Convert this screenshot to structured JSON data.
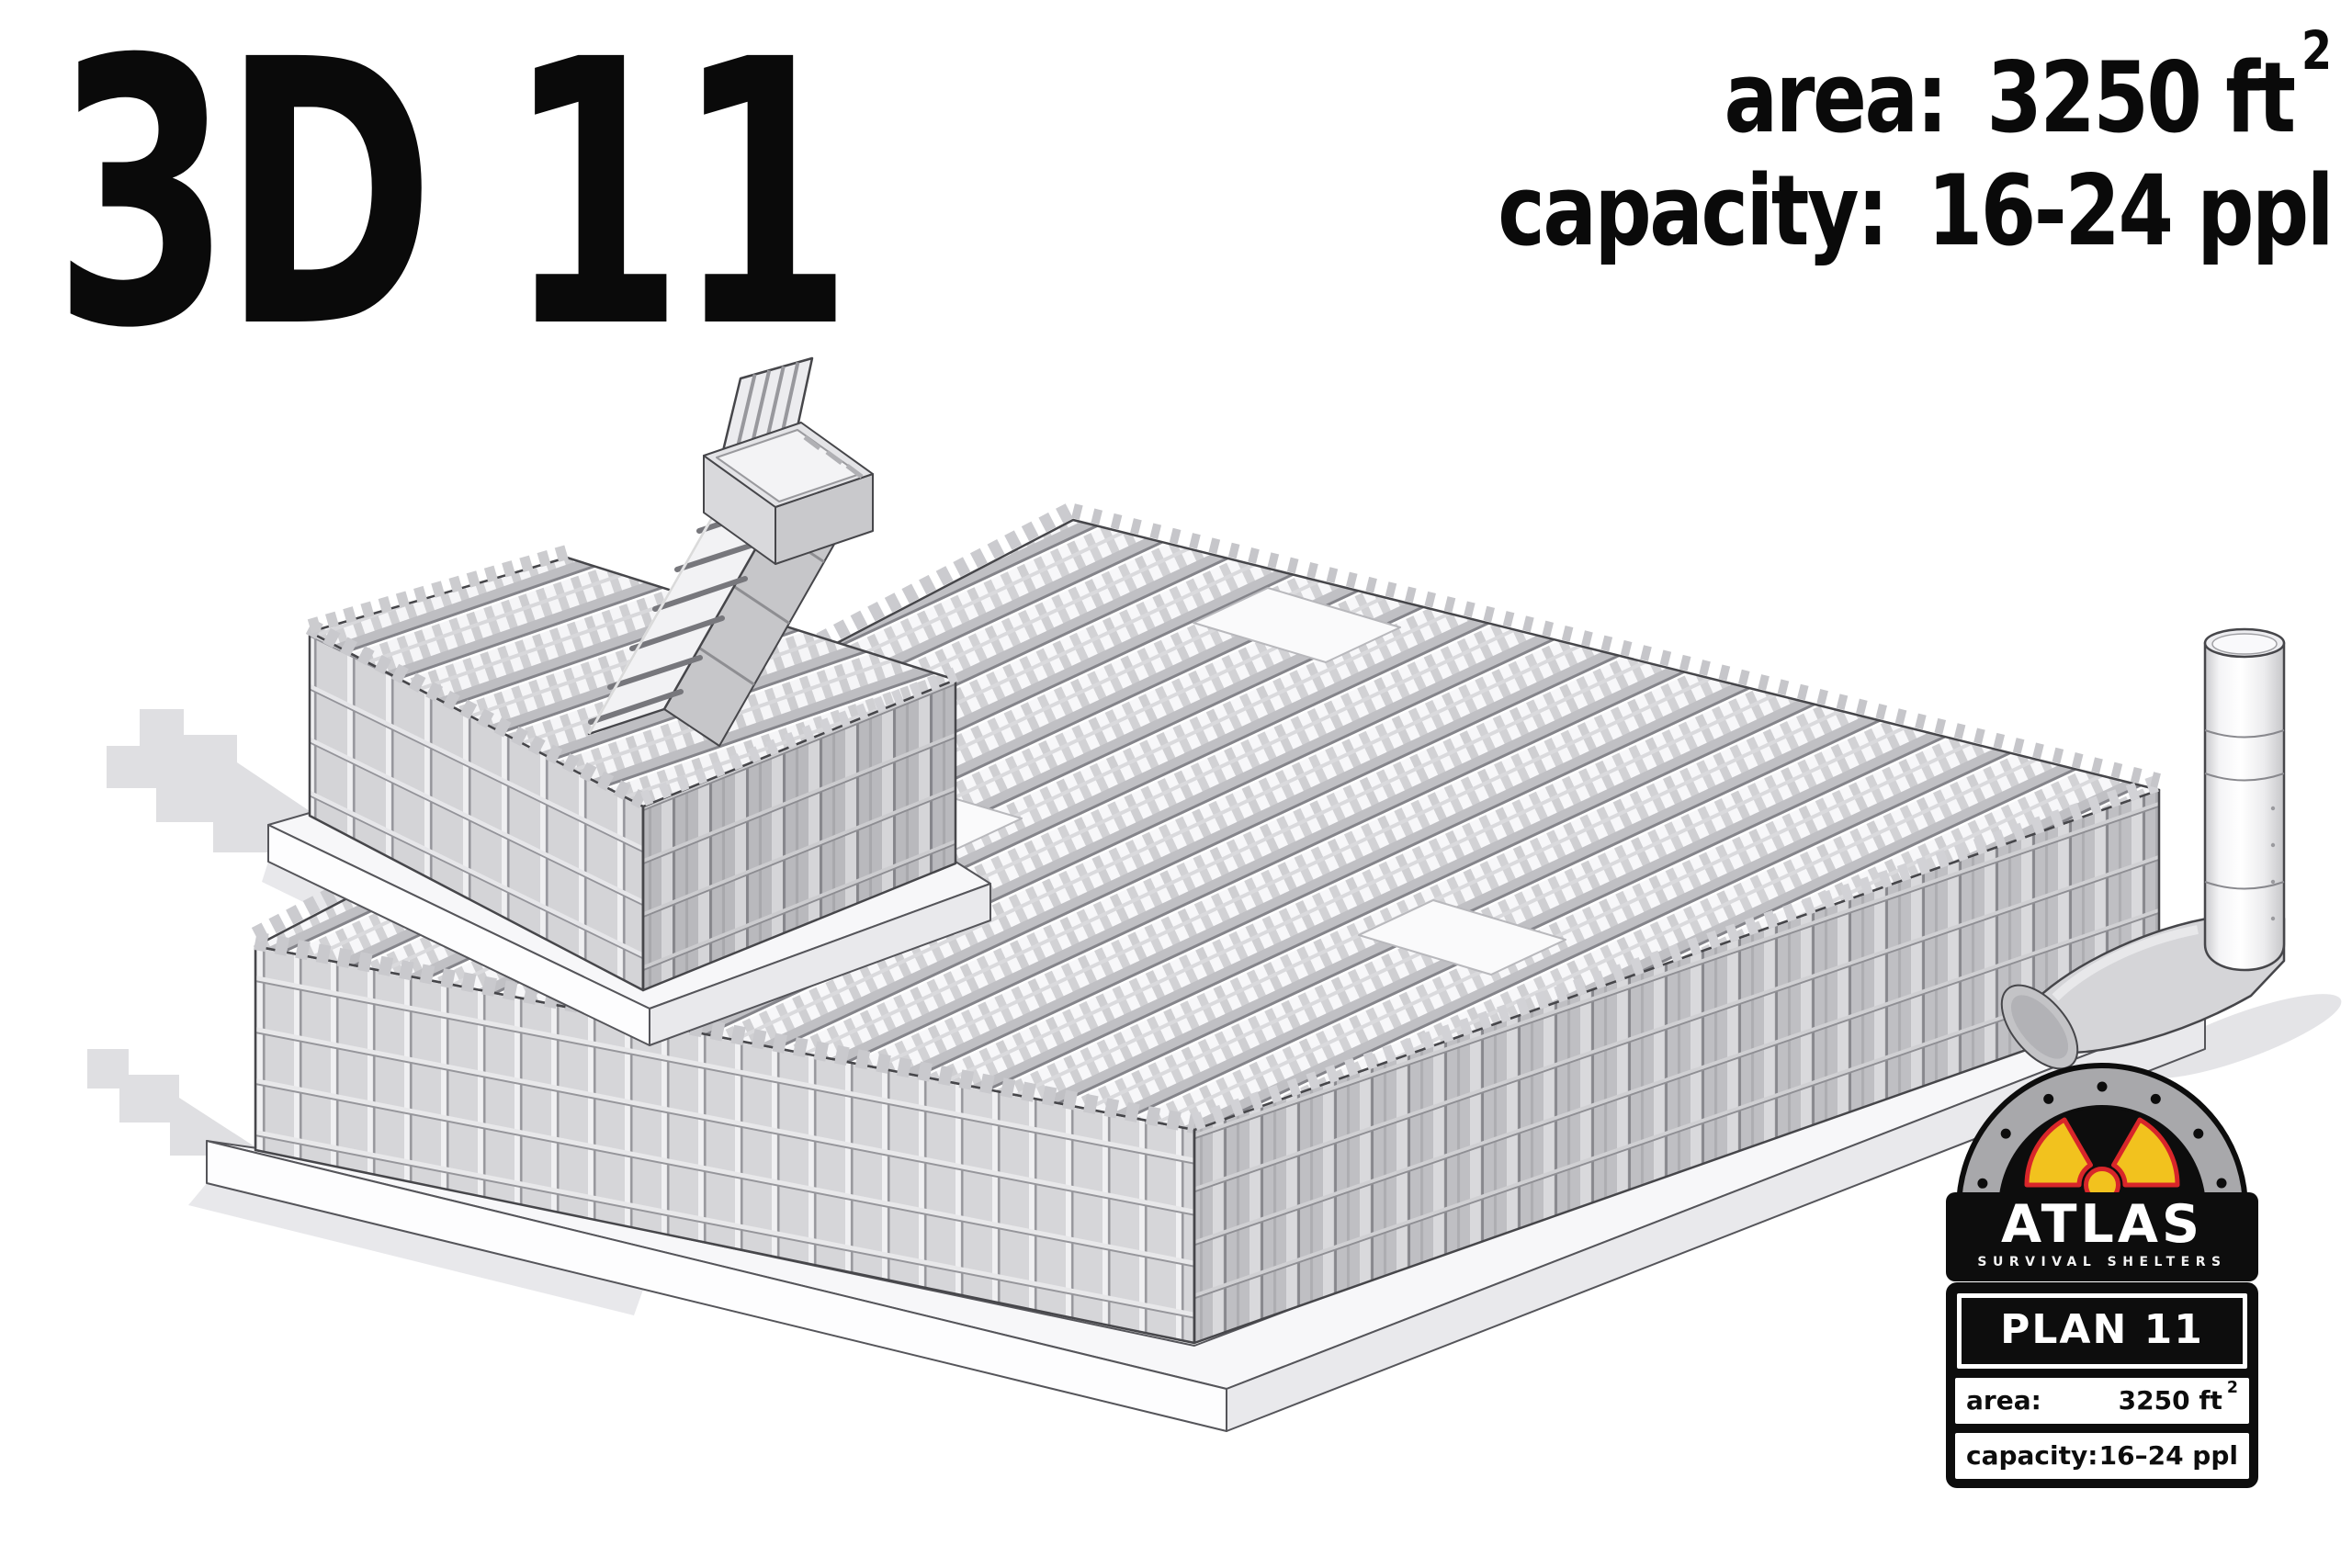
{
  "page": {
    "background": "#ffffff"
  },
  "header": {
    "title": "3D 11",
    "specs": {
      "area_label": "area:",
      "area_value": "3250 ft",
      "area_sup": "2",
      "capacity_label": "capacity:",
      "capacity_value": "16-24 ppl"
    }
  },
  "badge": {
    "brand": "ATLAS",
    "tagline": "SURVIVAL SHELTERS",
    "plan": "PLAN 11",
    "area_label": "area:",
    "area_value": "3250 ft",
    "area_sup": "2",
    "capacity_label": "capacity:",
    "capacity_value": "16–24 ppl",
    "colors": {
      "black": "#0d0d0d",
      "steel_gray": "#a8a8ab",
      "radiation_yellow": "#f2c21e",
      "radiation_red": "#d8262a",
      "white": "#ffffff"
    }
  },
  "illustration": {
    "type": "isometric-technical-render",
    "subject": "Underground survival shelter PLAN 11 — welded steel rebar cage structure on foundation slab",
    "parts": [
      "entrance-hatch-with-open-lid",
      "stair-tunnel",
      "entrance-annex-cage",
      "main-shelter-cage",
      "roof-beam-grid",
      "foundation-slab",
      "air-vent-pipe-elbow",
      "ground-shadow"
    ],
    "palette": {
      "outline": "#46464a",
      "face_light": "#f2f2f4",
      "face_mid": "#d7d7da",
      "face_dark": "#c3c3c7",
      "shadow": "#dfdfe2"
    }
  }
}
